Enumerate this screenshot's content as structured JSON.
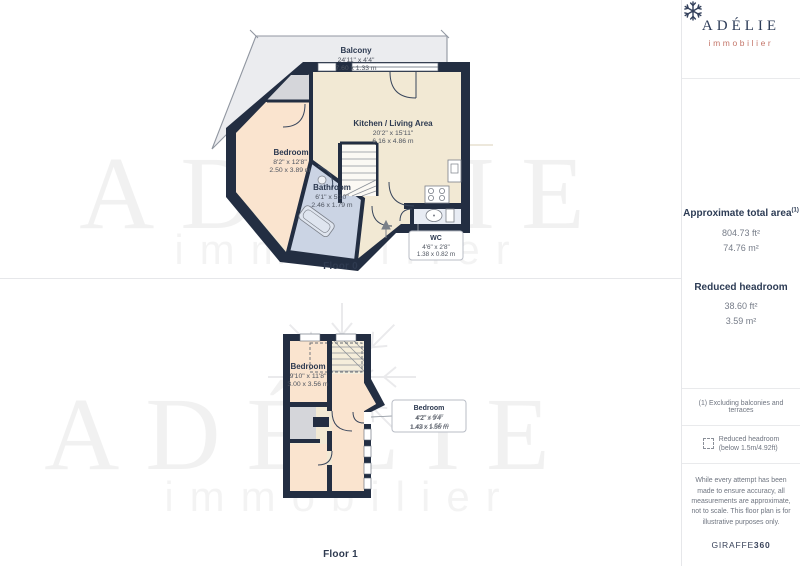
{
  "sidebar": {
    "logo": {
      "name": "ADÉLIE",
      "subtitle": "immobilier",
      "icon": "snowflake"
    },
    "area": {
      "title": "Approximate total area",
      "title_sup": "(1)",
      "total_ft": "804.73 ft²",
      "total_m": "74.76 m²",
      "headroom_title": "Reduced headroom",
      "headroom_ft": "38.60 ft²",
      "headroom_m": "3.59 m²"
    },
    "footnotes": {
      "note1": "(1) Excluding balconies and terraces",
      "legend_line1": "Reduced headroom",
      "legend_line2": "(below 1.5m/4.92ft)",
      "disclaimer": "While every attempt has been made to ensure accuracy, all measurements are approximate, not to scale. This floor plan is for illustrative purposes only.",
      "brand": "GIRAFFE",
      "brand_bold": "360"
    }
  },
  "floor0": {
    "label": "Floor 0",
    "balcony": {
      "name": "Balcony",
      "ft": "24'11\" x 4'4\"",
      "m": "7.60 x 1.33 m"
    },
    "kitchen": {
      "name": "Kitchen / Living Area",
      "ft": "20'2\" x 15'11\"",
      "m": "6.16 x 4.86 m"
    },
    "bedroom": {
      "name": "Bedroom",
      "ft": "8'2\" x 12'8\"",
      "m": "2.50 x 3.89 m"
    },
    "bathroom": {
      "name": "Bathroom",
      "ft": "6'1\" x 5'10\"",
      "m": "2.46 x 1.79 m"
    },
    "wc": {
      "name": "WC",
      "ft": "4'6\" x 2'8\"",
      "m": "1.38 x 0.82 m"
    }
  },
  "floor1": {
    "label": "Floor 1",
    "bedroom1": {
      "name": "Bedroom",
      "ft": "9'10\" x 11'8\"",
      "m": "3.00 x 3.56 m"
    },
    "bedroom2": {
      "name": "Bedroom",
      "ft": "4'2\" x 9'4\"",
      "m": "1.43 x 1.56 m"
    }
  },
  "watermark": {
    "title": "ADÉLIE",
    "subtitle": "immobilier"
  },
  "colors": {
    "wall": "#232e42",
    "kitchen_fill": "#f2e9d4",
    "bedroom_fill": "#fae4cf",
    "bathroom_fill": "#cbd4e4",
    "balcony_fill": "#ebecef",
    "landing_fill": "#d5d6da",
    "accent_coral": "#c4766a",
    "navy_text": "#2e3d59"
  }
}
